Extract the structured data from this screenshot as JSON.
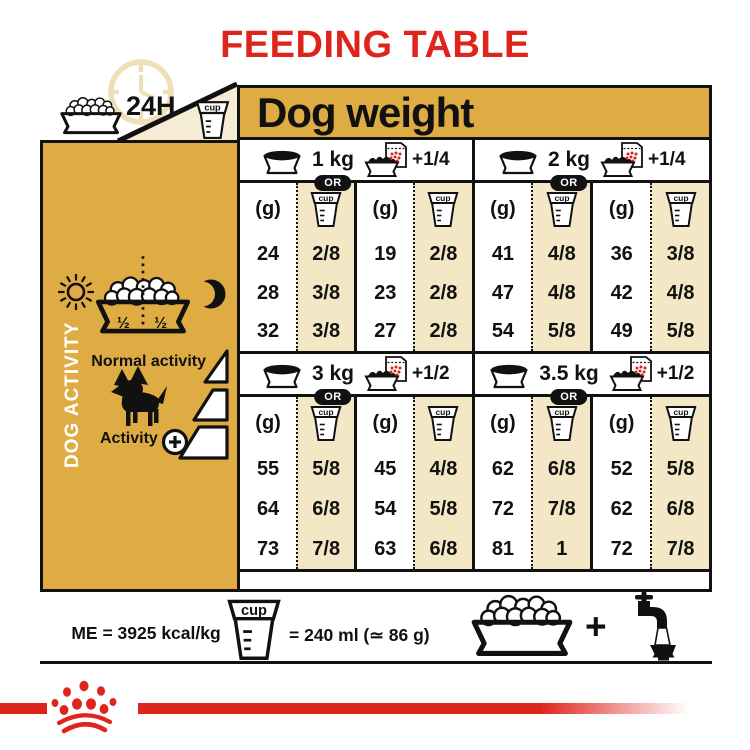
{
  "title": "FEEDING TABLE",
  "labels": {
    "cup": "cup",
    "hours": "24H"
  },
  "dog_weight_header": "Dog weight",
  "colors": {
    "red": "#DF241C",
    "gold": "#DEAC42",
    "cream": "#F4E7C6",
    "ink": "#111111"
  },
  "sidebar": {
    "vertical_label": "DOG ACTIVITY",
    "half_left": "½",
    "half_right": "½",
    "normal_activity_label": "Normal activity",
    "activity_label": "Activity"
  },
  "sections": [
    {
      "weight": "1 kg",
      "or_label": "OR",
      "add_label": "+1/4",
      "columns": [
        {
          "unit": "(g)",
          "values": [
            "24",
            "28",
            "32"
          ]
        },
        {
          "unit": "cup",
          "values": [
            "2/8",
            "3/8",
            "3/8"
          ]
        },
        {
          "unit": "(g)",
          "values": [
            "19",
            "23",
            "27"
          ]
        },
        {
          "unit": "cup",
          "values": [
            "2/8",
            "2/8",
            "2/8"
          ]
        }
      ]
    },
    {
      "weight": "2 kg",
      "or_label": "OR",
      "add_label": "+1/4",
      "columns": [
        {
          "unit": "(g)",
          "values": [
            "41",
            "47",
            "54"
          ]
        },
        {
          "unit": "cup",
          "values": [
            "4/8",
            "4/8",
            "5/8"
          ]
        },
        {
          "unit": "(g)",
          "values": [
            "36",
            "42",
            "49"
          ]
        },
        {
          "unit": "cup",
          "values": [
            "3/8",
            "4/8",
            "5/8"
          ]
        }
      ]
    },
    {
      "weight": "3 kg",
      "or_label": "OR",
      "add_label": "+1/2",
      "columns": [
        {
          "unit": "(g)",
          "values": [
            "55",
            "64",
            "73"
          ]
        },
        {
          "unit": "cup",
          "values": [
            "5/8",
            "6/8",
            "7/8"
          ]
        },
        {
          "unit": "(g)",
          "values": [
            "45",
            "54",
            "63"
          ]
        },
        {
          "unit": "cup",
          "values": [
            "4/8",
            "5/8",
            "6/8"
          ]
        }
      ]
    },
    {
      "weight": "3.5 kg",
      "or_label": "OR",
      "add_label": "+1/2",
      "columns": [
        {
          "unit": "(g)",
          "values": [
            "62",
            "72",
            "81"
          ]
        },
        {
          "unit": "cup",
          "values": [
            "6/8",
            "7/8",
            "1"
          ]
        },
        {
          "unit": "(g)",
          "values": [
            "52",
            "62",
            "72"
          ]
        },
        {
          "unit": "cup",
          "values": [
            "5/8",
            "6/8",
            "7/8"
          ]
        }
      ]
    }
  ],
  "footer": {
    "me_label": "ME = 3925 kcal/kg",
    "cup_equiv_label": "= 240 ml (≃ 86 g)",
    "plus": "+"
  },
  "chart_data": {
    "type": "table",
    "title": "FEEDING TABLE",
    "column_header": "Dog weight",
    "visible_activity_labels": [
      "Normal activity",
      "Activity"
    ],
    "rows_per_weight": 3,
    "me_kcal_per_kg": 3925,
    "cup_ml": 240,
    "cup_g": 86,
    "by_weight": [
      {
        "dog_weight": "1 kg",
        "wet_add": "+1/4",
        "kibble_only_g": [
          24,
          28,
          32
        ],
        "kibble_only_cup": [
          "2/8",
          "3/8",
          "3/8"
        ],
        "with_wet_g": [
          19,
          23,
          27
        ],
        "with_wet_cup": [
          "2/8",
          "2/8",
          "2/8"
        ]
      },
      {
        "dog_weight": "2 kg",
        "wet_add": "+1/4",
        "kibble_only_g": [
          41,
          47,
          54
        ],
        "kibble_only_cup": [
          "4/8",
          "4/8",
          "5/8"
        ],
        "with_wet_g": [
          36,
          42,
          49
        ],
        "with_wet_cup": [
          "3/8",
          "4/8",
          "5/8"
        ]
      },
      {
        "dog_weight": "3 kg",
        "wet_add": "+1/2",
        "kibble_only_g": [
          55,
          64,
          73
        ],
        "kibble_only_cup": [
          "5/8",
          "6/8",
          "7/8"
        ],
        "with_wet_g": [
          45,
          54,
          63
        ],
        "with_wet_cup": [
          "4/8",
          "5/8",
          "6/8"
        ]
      },
      {
        "dog_weight": "3.5 kg",
        "wet_add": "+1/2",
        "kibble_only_g": [
          62,
          72,
          81
        ],
        "kibble_only_cup": [
          "6/8",
          "7/8",
          "1"
        ],
        "with_wet_g": [
          52,
          62,
          72
        ],
        "with_wet_cup": [
          "5/8",
          "6/8",
          "7/8"
        ]
      }
    ]
  }
}
